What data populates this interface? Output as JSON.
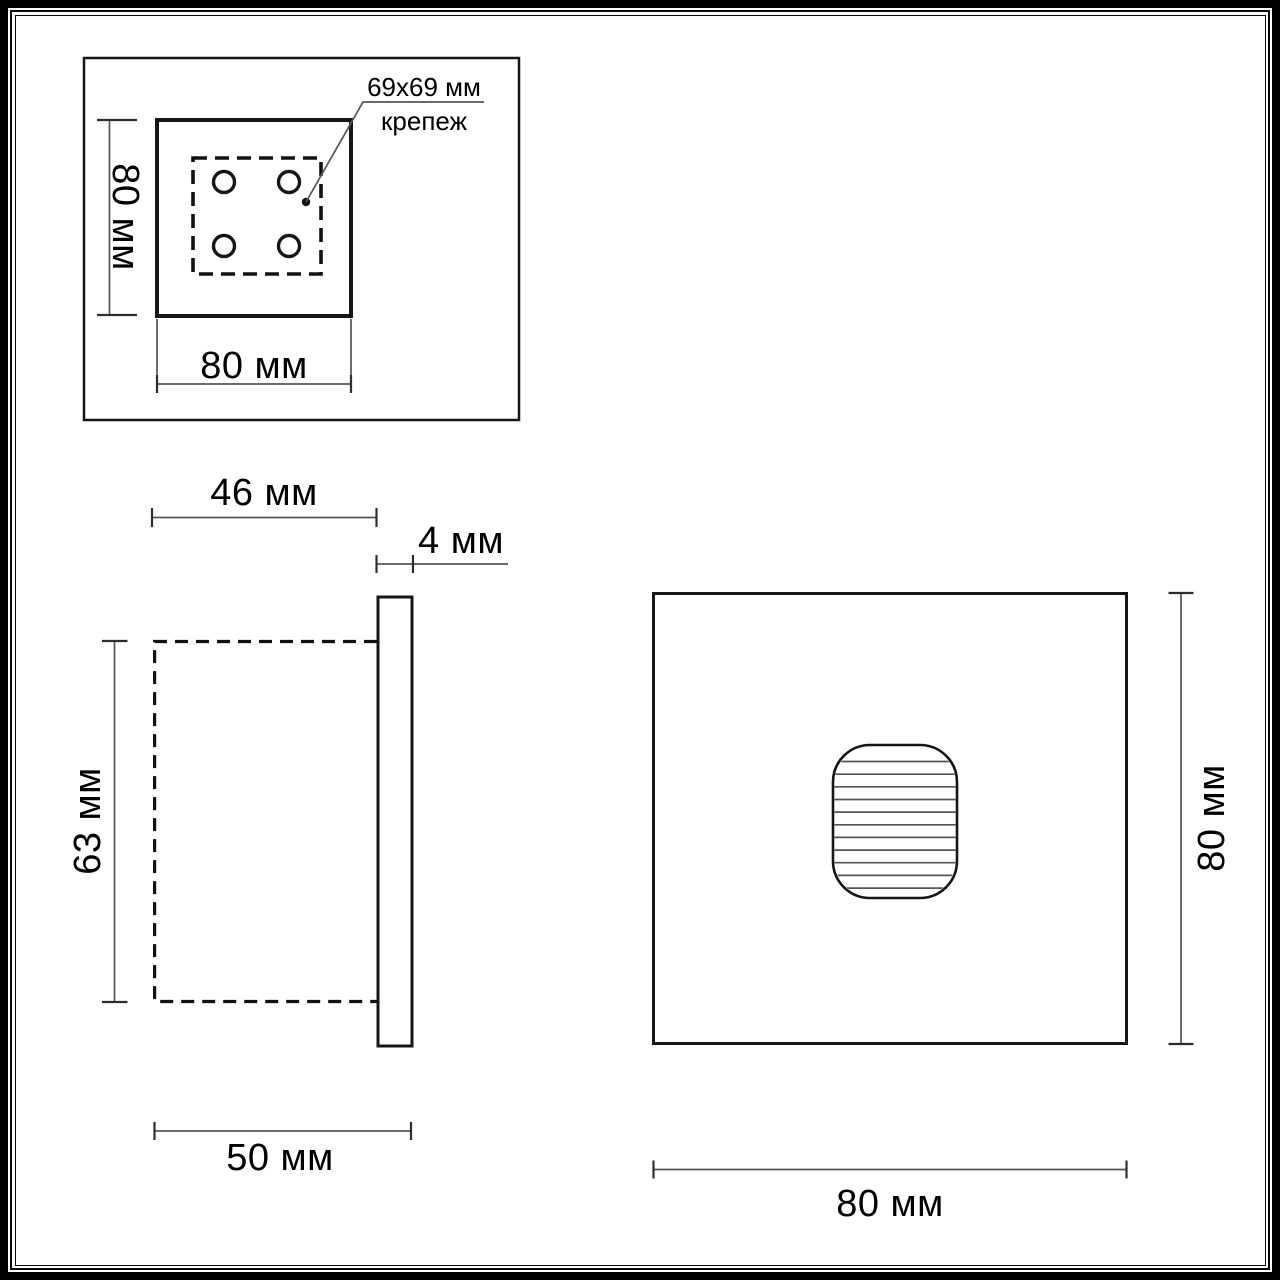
{
  "colors": {
    "background": "#ffffff",
    "object_line": "#161616",
    "dimension_line": "#555555",
    "text": "#000000"
  },
  "top_view": {
    "height_label": "80 мм",
    "width_label": "80 мм",
    "callout": {
      "line1": "69x69 мм",
      "line2": "крепеж"
    }
  },
  "side_view": {
    "recess_depth_label": "46 мм",
    "plate_thickness_label": "4 мм",
    "recess_height_label": "63 мм",
    "overall_depth_label": "50 мм"
  },
  "front_view": {
    "height_label": "80 мм",
    "width_label": "80 мм"
  }
}
